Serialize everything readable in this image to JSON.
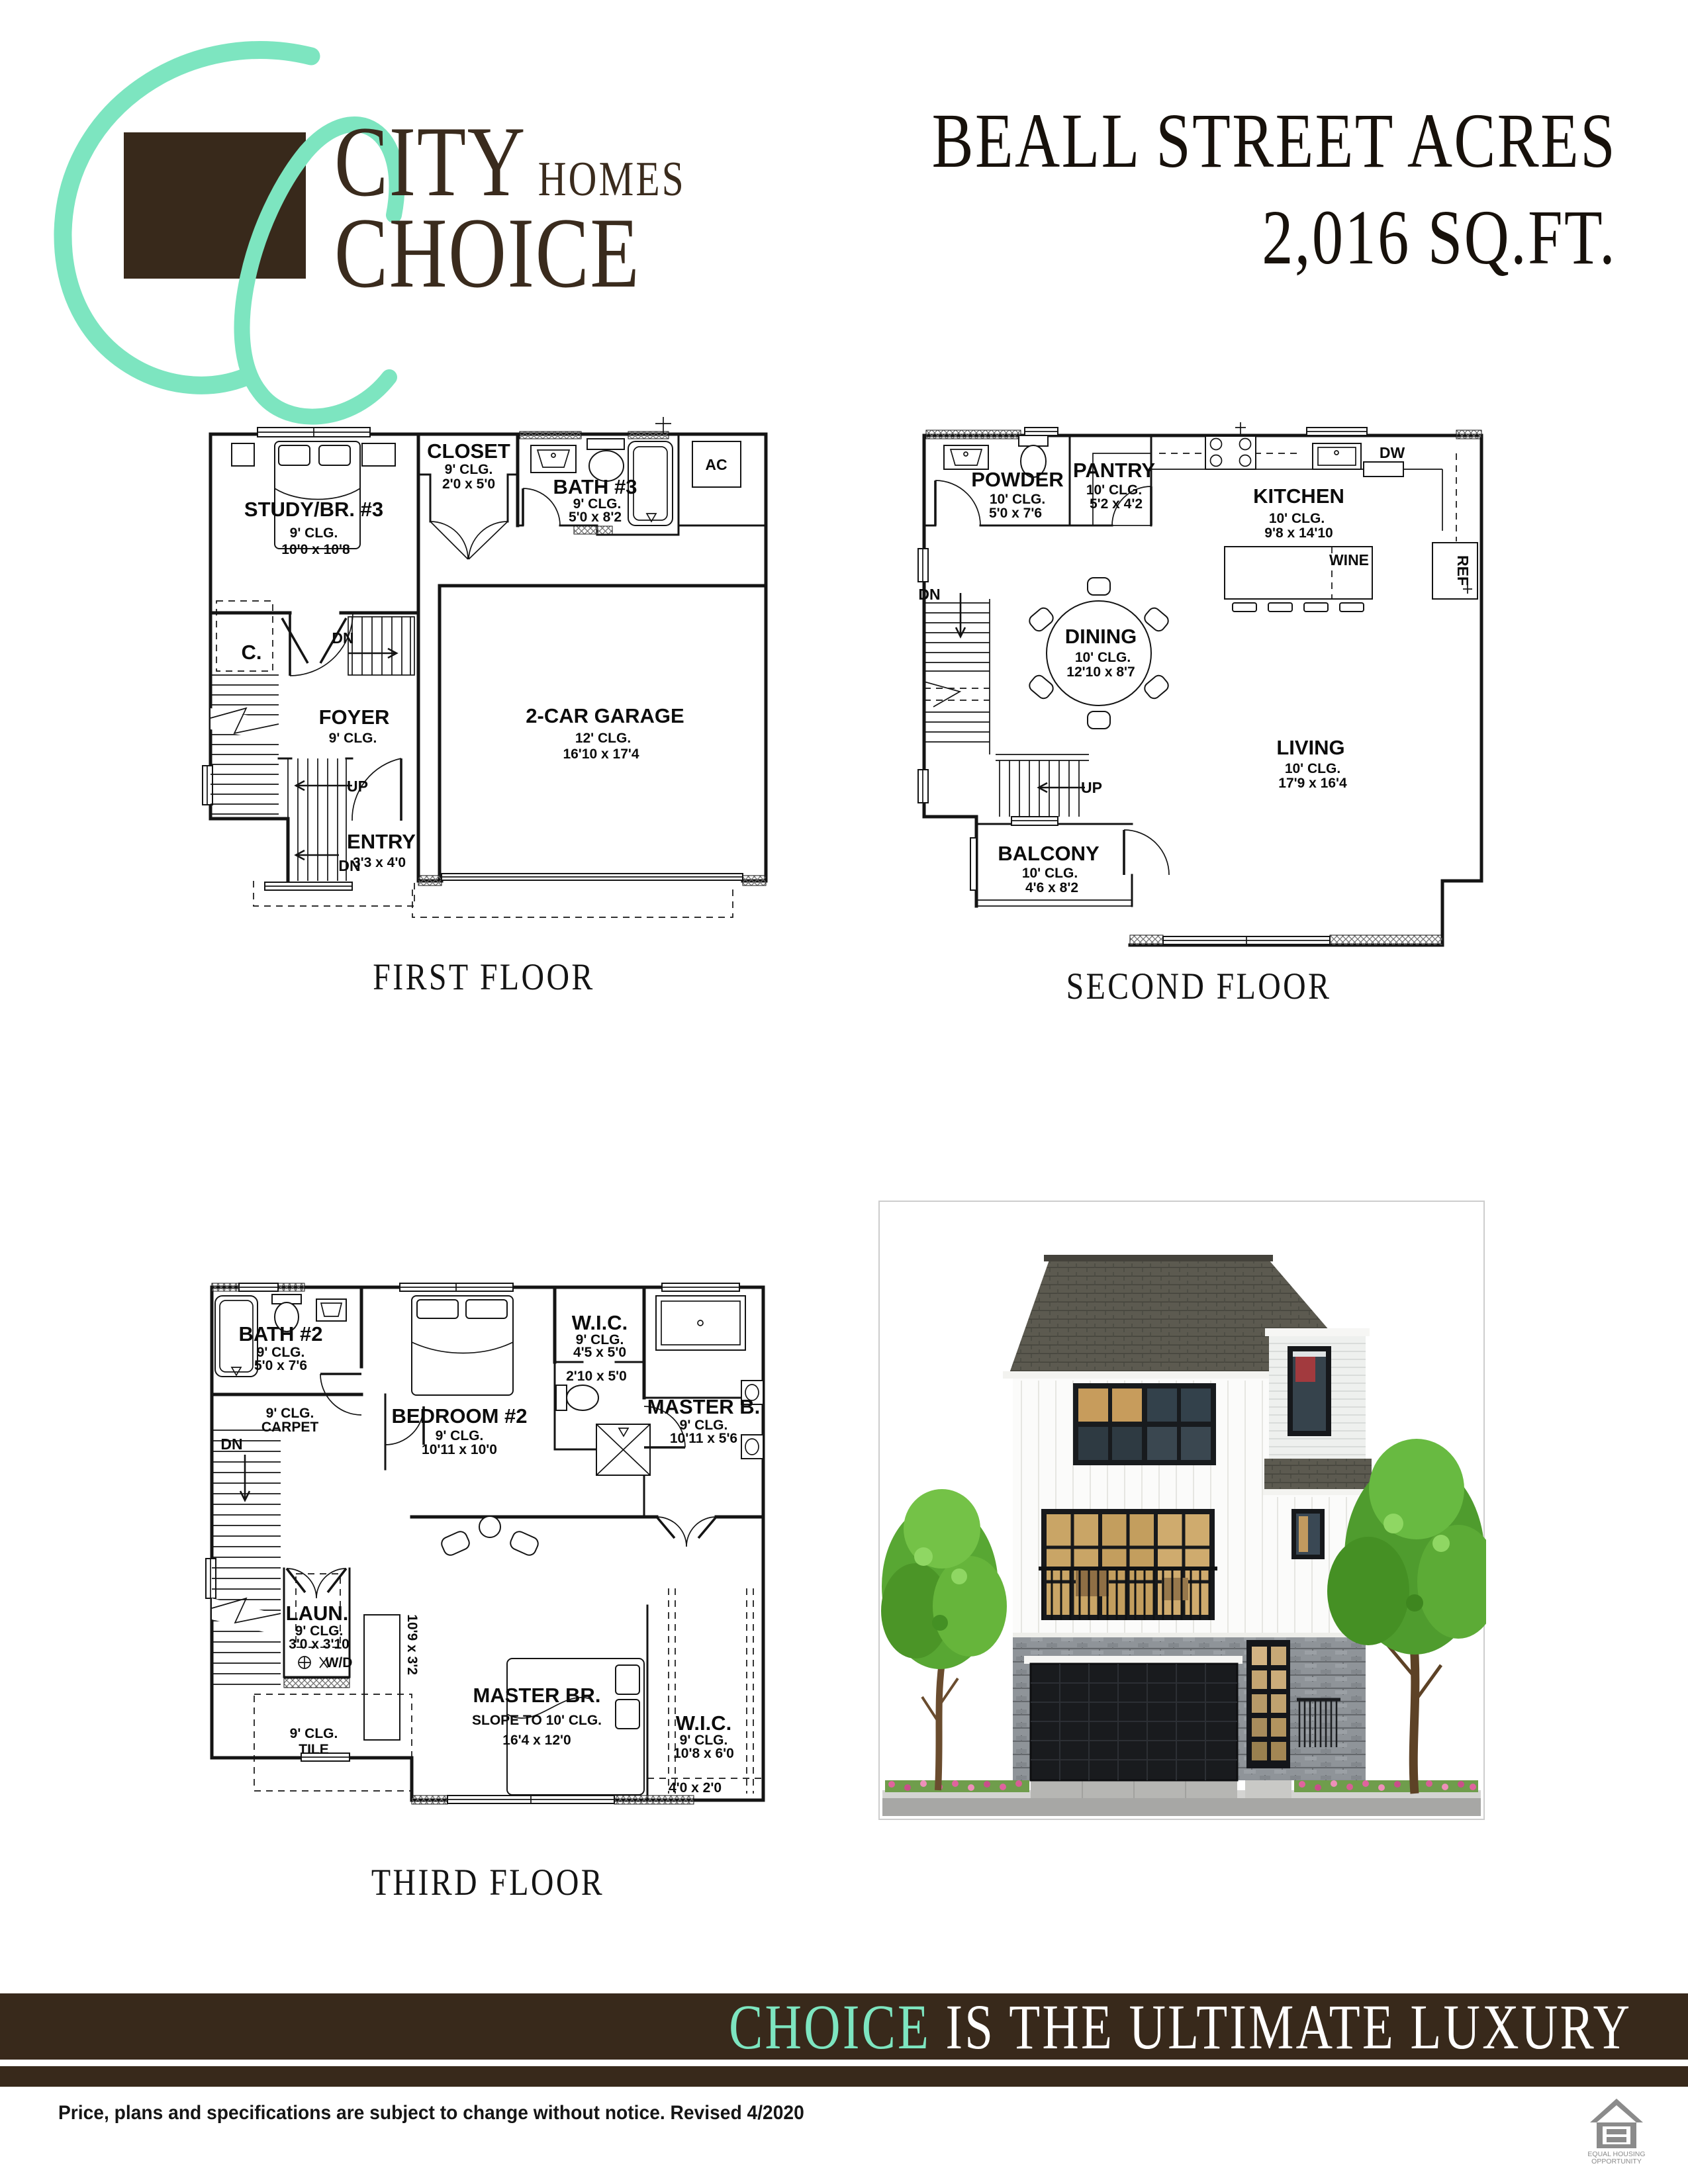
{
  "brand": {
    "city": "CITY",
    "homes": "HOMES",
    "choice": "CHOICE"
  },
  "title": {
    "line1": "BEALL STREET ACRES",
    "line2": "2,016 SQ.FT."
  },
  "captions": {
    "first": "FIRST FLOOR",
    "second": "SECOND FLOOR",
    "third": "THIRD FLOOR"
  },
  "plan1": {
    "study_name": "STUDY/BR. #3",
    "study_clg": "9' CLG.",
    "study_dims": "10'0 x 10'8",
    "closet_name": "CLOSET",
    "closet_clg": "9' CLG.",
    "closet_dims": "2'0 x 5'0",
    "bath_name": "BATH #3",
    "bath_clg": "9' CLG.",
    "bath_dims": "5'0 x 8'2",
    "ac": "AC",
    "c_label": "C.",
    "dn_upper": "DN",
    "foyer_name": "FOYER",
    "foyer_clg": "9' CLG.",
    "up": "UP",
    "garage_name": "2-CAR GARAGE",
    "garage_clg": "12' CLG.",
    "garage_dims": "16'10 x 17'4",
    "entry_name": "ENTRY",
    "entry_dims": "3'3 x 4'0",
    "dn_lower": "DN"
  },
  "plan2": {
    "powder_name": "POWDER",
    "powder_clg": "10' CLG.",
    "powder_dims": "5'0 x 7'6",
    "pantry_name": "PANTRY",
    "pantry_clg": "10' CLG.",
    "pantry_dims": "5'2 x 4'2",
    "kitchen_name": "KITCHEN",
    "kitchen_clg": "10' CLG.",
    "kitchen_dims": "9'8 x 14'10",
    "dw": "DW",
    "wine": "WINE",
    "ref": "REF",
    "dining_name": "DINING",
    "dining_clg": "10' CLG.",
    "dining_dims": "12'10 x 8'7",
    "dn": "DN",
    "up": "UP",
    "living_name": "LIVING",
    "living_clg": "10' CLG.",
    "living_dims": "17'9 x 16'4",
    "balcony_name": "BALCONY",
    "balcony_clg": "10' CLG.",
    "balcony_dims": "4'6 x 8'2"
  },
  "plan3": {
    "bath2_name": "BATH #2",
    "bath2_clg": "9' CLG.",
    "bath2_dims": "5'0 x 7'6",
    "bedroom2_name": "BEDROOM #2",
    "bedroom2_clg": "9' CLG.",
    "bedroom2_dims": "10'11 x 10'0",
    "wic1_name": "W.I.C.",
    "wic1_clg": "9' CLG.",
    "wic1_dims": "4'5 x 5'0",
    "toilet_dims": "2'10 x 5'0",
    "masterb_name": "MASTER B.",
    "masterb_clg": "9' CLG.",
    "masterb_dims": "10'11 x 5'6",
    "landing_clg": "9' CLG.",
    "landing_floor": "CARPET",
    "dn": "DN",
    "laun_name": "LAUN.",
    "laun_clg": "9' CLG.",
    "laun_dims": "3'0 x 3'10",
    "wd": "W/D",
    "tile_clg": "9' CLG.",
    "tile_floor": "TILE",
    "hall_dims": "10'9 x 3'2",
    "masterbr_name": "MASTER BR.",
    "masterbr_slope": "SLOPE TO 10' CLG.",
    "masterbr_dims": "16'4 x 12'0",
    "wic2_name": "W.I.C.",
    "wic2_clg": "9' CLG.",
    "wic2_dims": "10'8 x 6'0",
    "porch_dims": "4'0 x 2'0"
  },
  "banner": {
    "highlight": "CHOICE",
    "rest": " IS THE ULTIMATE LUXURY"
  },
  "footer": {
    "disclaimer": "Price, plans and specifications are subject to change without notice. Revised 4/2020",
    "eho_line1": "EQUAL HOUSING",
    "eho_line2": "OPPORTUNITY"
  },
  "colors": {
    "brand_brown": "#38291b",
    "brand_mint": "#7de5c0"
  }
}
